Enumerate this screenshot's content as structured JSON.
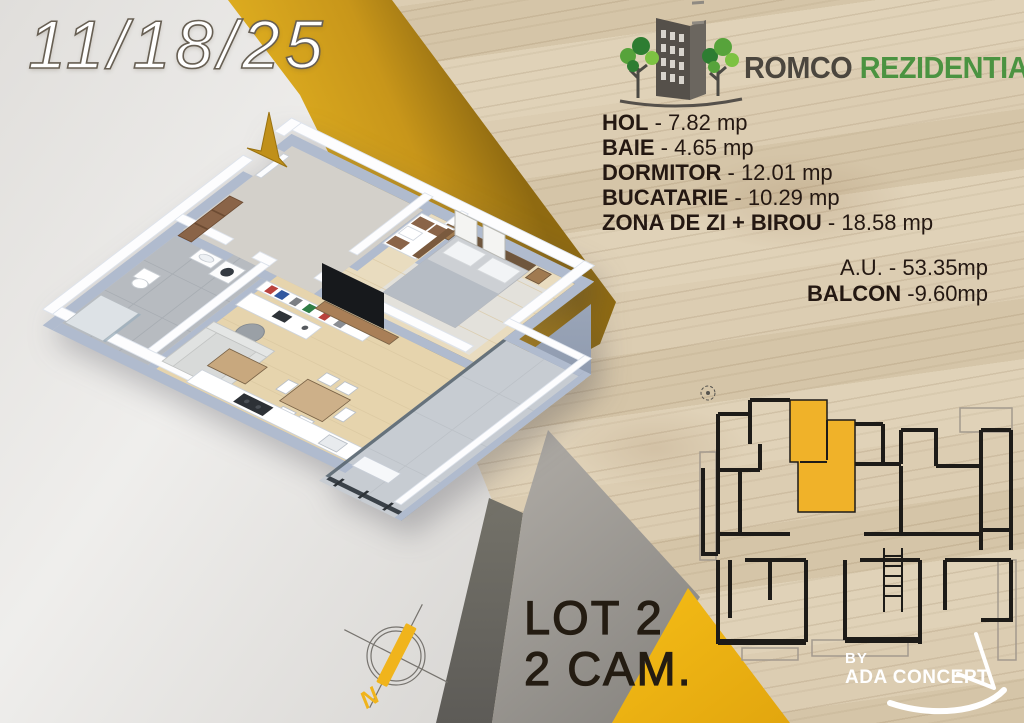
{
  "date": "11/18/25",
  "brand": {
    "primary": "ROMCO",
    "secondary": "REZIDENTIAL"
  },
  "rooms": {
    "items": [
      {
        "name": "HOL",
        "sep": " - ",
        "area": "7.82 mp"
      },
      {
        "name": "BAIE",
        "sep": " - ",
        "area": "4.65 mp"
      },
      {
        "name": "DORMITOR",
        "sep": " - ",
        "area": "12.01 mp"
      },
      {
        "name": "BUCATARIE",
        "sep": " - ",
        "area": "10.29 mp"
      },
      {
        "name": "ZONA DE ZI + BIROU",
        "sep": " - ",
        "area": "18.58 mp"
      }
    ]
  },
  "totals": {
    "au_label": "A.U.",
    "au_sep": " - ",
    "au_value": "53.35mp",
    "balcon_label": "BALCON",
    "balcon_sep": " -",
    "balcon_value": "9.60mp"
  },
  "lot": {
    "line1": "LOT 2",
    "line2": "2 CAM."
  },
  "credit": {
    "by": "BY",
    "name": "ADA CONCEPT"
  },
  "compass": {
    "north_label": "N"
  },
  "colors": {
    "gold": "#c0901a",
    "gold_bright": "#f0b41c",
    "unit_highlight": "#f0b229",
    "green": "#4b9341",
    "charcoal": "#4b463e",
    "text_dark": "#241812"
  }
}
